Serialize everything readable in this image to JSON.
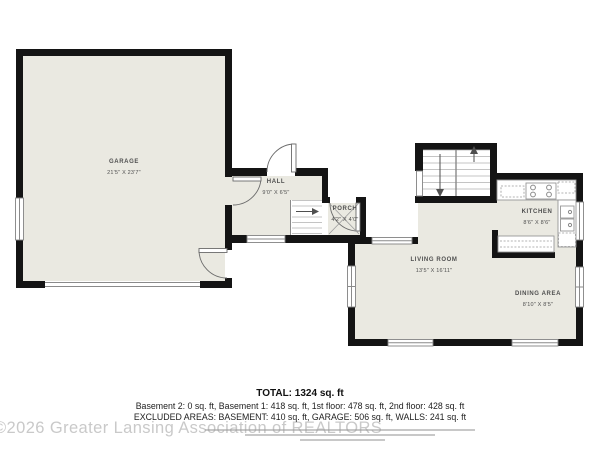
{
  "plan": {
    "rooms": [
      {
        "name": "GARAGE",
        "dims": "21'5\" X 23'7\""
      },
      {
        "name": "HALL",
        "dims": "9'0\" X 6'5\""
      },
      {
        "name": "PORCH",
        "dims": "4'2\" X 4'0\""
      },
      {
        "name": "LIVING ROOM",
        "dims": "13'5\" X 16'11\""
      },
      {
        "name": "KITCHEN",
        "dims": "8'6\" X 8'6\""
      },
      {
        "name": "DINING AREA",
        "dims": "8'10\" X 8'5\""
      }
    ]
  },
  "summary": {
    "total": "TOTAL: 1324 sq. ft",
    "floors": "Basement 2: 0 sq. ft, Basement 1: 418 sq. ft, 1st floor: 478 sq. ft, 2nd floor: 428 sq. ft",
    "excluded": "EXCLUDED AREAS: BASEMENT: 410 sq. ft, GARAGE: 506 sq. ft, WALLS: 241 sq. ft"
  },
  "watermark": "©2026 Greater Lansing Association of REALTORS",
  "colors": {
    "floor_fill": "#eae9e1",
    "wall": "#141414",
    "label_text": "#4f4f4f",
    "summary_text": "#1d1d1d",
    "watermark_gray": "#c0c0c0"
  }
}
